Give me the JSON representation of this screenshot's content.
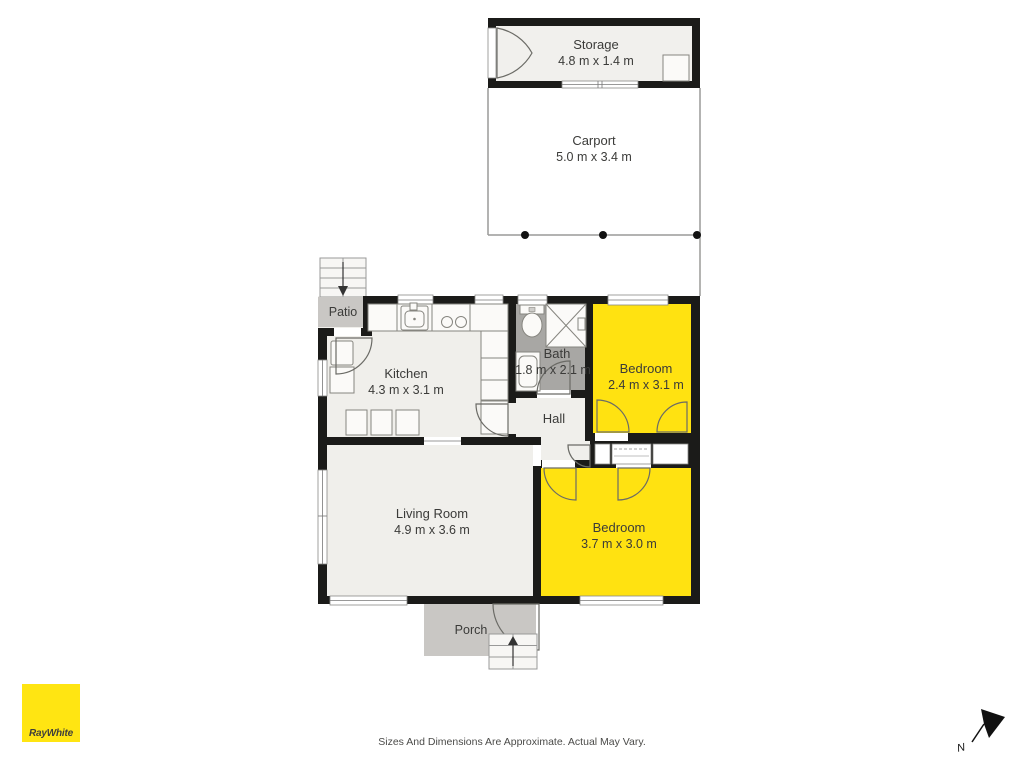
{
  "rooms": {
    "storage": {
      "name": "Storage",
      "dims": "4.8 m x 1.4 m"
    },
    "carport": {
      "name": "Carport",
      "dims": "5.0 m x 3.4 m"
    },
    "patio": {
      "name": "Patio"
    },
    "kitchen": {
      "name": "Kitchen",
      "dims": "4.3 m x 3.1 m"
    },
    "bath": {
      "name": "Bath",
      "dims": "1.8 m x 2.1 m"
    },
    "bedroom_top": {
      "name": "Bedroom",
      "dims": "2.4 m x 3.1 m"
    },
    "hall": {
      "name": "Hall"
    },
    "living_room": {
      "name": "Living Room",
      "dims": "4.9 m x 3.6 m"
    },
    "bedroom_bottom": {
      "name": "Bedroom",
      "dims": "3.7 m x 3.0 m"
    },
    "porch": {
      "name": "Porch"
    }
  },
  "footer": {
    "disclaimer": "Sizes And Dimensions Are Approximate. Actual May Vary."
  },
  "branding": {
    "logo_text": "RayWhite",
    "logo_color": "#FFE512"
  },
  "compass": {
    "north_label": "N"
  },
  "colors": {
    "highlight_room": "#FFE211",
    "wall": "#1B1B19",
    "floor": "#F0EFEB",
    "outdoor_gray": "#C9C7C4",
    "bath_floor": "#A8A7A4",
    "brand_yellow": "#FFE512"
  }
}
